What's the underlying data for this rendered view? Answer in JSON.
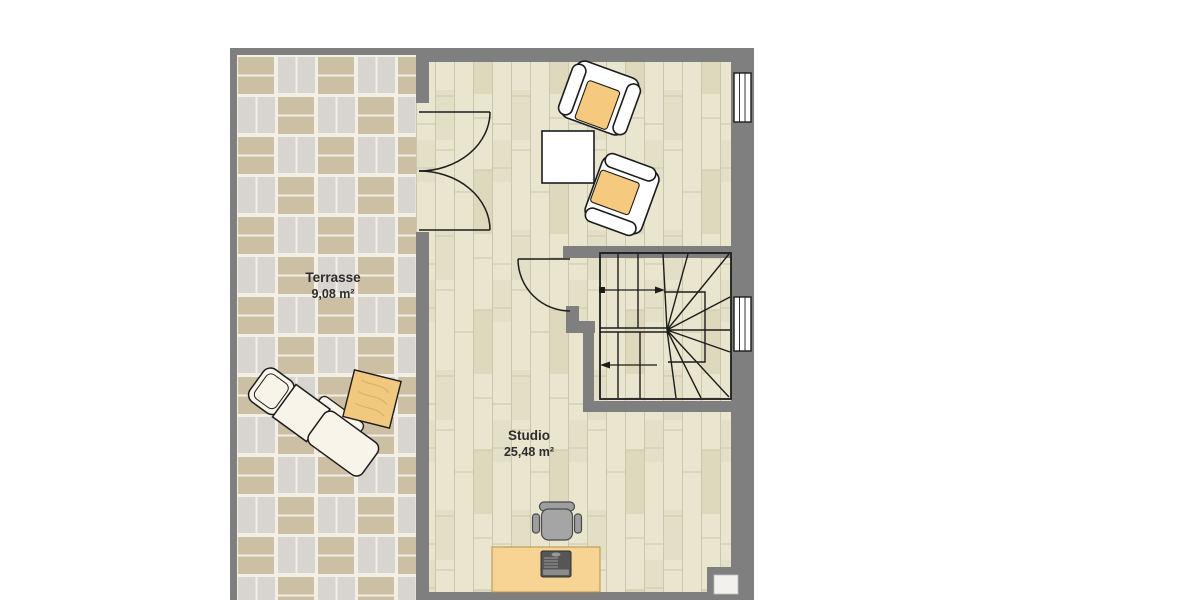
{
  "plan": {
    "title": "floor plan",
    "rooms": [
      {
        "name": "Terrasse",
        "area": "9,08 m²"
      },
      {
        "name": "Studio",
        "area": "25,48 m²"
      }
    ]
  },
  "colors": {
    "wall": "#7f7f7f",
    "wood_floor": "#e9e5ce",
    "tile_tan": "#cdbfa3",
    "tile_gray": "#d8d4d0",
    "grout": "#f1efe6",
    "accent_orange": "#f6ca7e",
    "desk_orange": "#f7d394",
    "table_orange": "#f0c87e",
    "furniture_white": "#ffffff",
    "chair_gray": "#a5a5a5",
    "line": "#1c1c1c",
    "background": "#ffffff"
  }
}
